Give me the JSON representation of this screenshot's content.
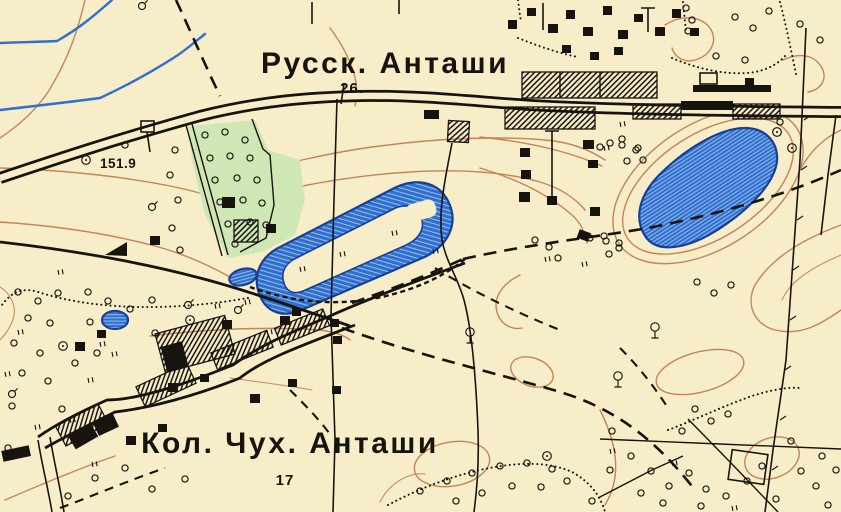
{
  "map": {
    "title": "Topographic map sheet — Antashi area",
    "labels": {
      "settlement_top": "Русск. Анташи",
      "km_marker_top": "26.",
      "elevation_point": "151.9",
      "settlement_bottom": "Кол. Чух. Анташи",
      "km_marker_bottom": "17"
    },
    "colors": {
      "paper": "#f7edc9",
      "ink": "#17140f",
      "contour": "#c17e52",
      "water_fill": "#2f6fd0",
      "water_stripe": "#9cc0ea",
      "water_edge": "#173f96",
      "orchard": "#cfe7b5"
    },
    "legend": {
      "double_line_road": "chaussee (main road)",
      "solid_line": "country road",
      "dashed_line": "field track / trail",
      "dotted_line": "footpath / boundary",
      "hatched_rect": "non-residential building",
      "black_square": "dwelling",
      "circle": "tree / bush",
      "double_tick": "meadow",
      "blue_area": "lake / pond",
      "brown_line": "contour line",
      "green_area": "orchard / garden"
    }
  }
}
